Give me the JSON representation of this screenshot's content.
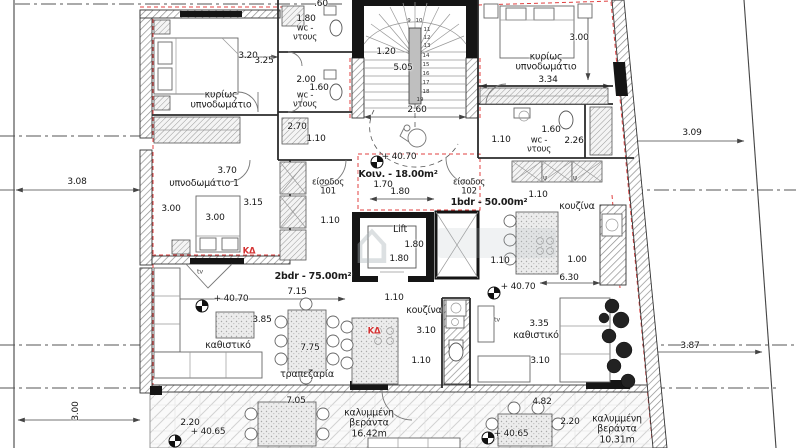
{
  "plan": {
    "drawing_type": "apartment floor plan",
    "apartments": [
      {
        "unit": "101",
        "label": "2bdr - 75.00m²"
      },
      {
        "unit": "102",
        "label": "1bdr - 50.00m²"
      },
      {
        "common": "Κοιν. - 18.00m²"
      }
    ],
    "colors": {
      "insulation_dashed": "#e04040",
      "kd_label": "#d43333",
      "wall_line": "#333333",
      "annotation_text": "#1b1b1b"
    },
    "room_labels": [
      {
        "t": "κυρίως\nυπνοδωμάτιο",
        "x": 221,
        "y": 101
      },
      {
        "t": "wc -\nντους",
        "x": 305,
        "y": 34,
        "cls": "s"
      },
      {
        "t": "wc -\nντους",
        "x": 305,
        "y": 101,
        "cls": "s"
      },
      {
        "t": "κυρίως\nυπνοδωμάτιο",
        "x": 546,
        "y": 63
      },
      {
        "t": "wc -\nντους",
        "x": 539,
        "y": 146,
        "cls": "s"
      },
      {
        "t": "υπνοδωμάτιο 1",
        "x": 204,
        "y": 184
      },
      {
        "t": "Κοιν. - 18.00m²",
        "x": 398,
        "y": 175,
        "cls": "b"
      },
      {
        "t": "είσοδος\n101",
        "x": 328,
        "y": 188,
        "cls": "s"
      },
      {
        "t": "είσοδος\n102",
        "x": 469,
        "y": 188,
        "cls": "s"
      },
      {
        "t": "1bdr - 50.00m²",
        "x": 489,
        "y": 203,
        "cls": "b"
      },
      {
        "t": "2bdr - 75.00m²",
        "x": 313,
        "y": 277,
        "cls": "b"
      },
      {
        "t": "κουζίνα",
        "x": 577,
        "y": 207
      },
      {
        "t": "κουζίνα",
        "x": 424,
        "y": 311
      },
      {
        "t": "καθιστικό",
        "x": 228,
        "y": 346
      },
      {
        "t": "καθιστικό",
        "x": 536,
        "y": 336
      },
      {
        "t": "τραπεζαρία",
        "x": 307,
        "y": 375
      },
      {
        "t": "καλυμμένη\nβεράντα\n16.42m",
        "x": 369,
        "y": 424
      },
      {
        "t": "καλυμμένη\nβεράντα\n10.31m",
        "x": 617,
        "y": 430
      },
      {
        "t": "Lift",
        "x": 400,
        "y": 230
      }
    ],
    "dimensions": [
      {
        "t": "3.20",
        "x": 248,
        "y": 57
      },
      {
        "t": "3.25",
        "x": 264,
        "y": 62
      },
      {
        "t": ".60",
        "x": 321,
        "y": 5
      },
      {
        "t": "1.80",
        "x": 306,
        "y": 20
      },
      {
        "t": "2.00",
        "x": 306,
        "y": 81
      },
      {
        "t": "1.60",
        "x": 319,
        "y": 89
      },
      {
        "t": "2.70",
        "x": 297,
        "y": 128
      },
      {
        "t": "1.10",
        "x": 316,
        "y": 140
      },
      {
        "t": "1.20",
        "x": 386,
        "y": 53
      },
      {
        "t": "5.05",
        "x": 403,
        "y": 69
      },
      {
        "t": "2.60",
        "x": 417,
        "y": 111
      },
      {
        "t": "3.00",
        "x": 579,
        "y": 39
      },
      {
        "t": "3.34",
        "x": 548,
        "y": 81
      },
      {
        "t": "1.10",
        "x": 501,
        "y": 141
      },
      {
        "t": "1.60",
        "x": 551,
        "y": 131
      },
      {
        "t": "2.26",
        "x": 574,
        "y": 142
      },
      {
        "t": "3.09",
        "x": 692,
        "y": 134
      },
      {
        "t": "3.08",
        "x": 77,
        "y": 183
      },
      {
        "t": "3.70",
        "x": 227,
        "y": 172
      },
      {
        "t": "3.00",
        "x": 171,
        "y": 210
      },
      {
        "t": "3.00",
        "x": 215,
        "y": 219
      },
      {
        "t": "3.15",
        "x": 253,
        "y": 204
      },
      {
        "t": "1.70",
        "x": 383,
        "y": 186
      },
      {
        "t": "1.80",
        "x": 400,
        "y": 193
      },
      {
        "t": "1.10",
        "x": 330,
        "y": 222
      },
      {
        "t": "1.80",
        "x": 414,
        "y": 246
      },
      {
        "t": "1.80",
        "x": 399,
        "y": 260
      },
      {
        "t": "1.10",
        "x": 500,
        "y": 262
      },
      {
        "t": "1.10",
        "x": 538,
        "y": 196
      },
      {
        "t": "1.00",
        "x": 577,
        "y": 261
      },
      {
        "t": "6.30",
        "x": 569,
        "y": 279
      },
      {
        "t": "7.15",
        "x": 297,
        "y": 293
      },
      {
        "t": "3.85",
        "x": 262,
        "y": 321
      },
      {
        "t": "7.75",
        "x": 310,
        "y": 349
      },
      {
        "t": "3.10",
        "x": 426,
        "y": 332
      },
      {
        "t": "1.10",
        "x": 421,
        "y": 362
      },
      {
        "t": "1.10",
        "x": 394,
        "y": 299
      },
      {
        "t": "3.35",
        "x": 539,
        "y": 325
      },
      {
        "t": "3.10",
        "x": 540,
        "y": 362
      },
      {
        "t": "3.87",
        "x": 690,
        "y": 347
      },
      {
        "t": "2.20",
        "x": 190,
        "y": 424
      },
      {
        "t": "7.05",
        "x": 296,
        "y": 402
      },
      {
        "t": "2.20",
        "x": 570,
        "y": 423
      },
      {
        "t": "4.82",
        "x": 542,
        "y": 403
      },
      {
        "t": "3.00",
        "x": 77,
        "y": 411,
        "rot": -90
      }
    ],
    "levels": [
      {
        "t": "+ 40.70",
        "x": 399,
        "y": 158,
        "bx": 377,
        "by": 162
      },
      {
        "t": "+ 40.70",
        "x": 231,
        "y": 300,
        "bx": 202,
        "by": 306
      },
      {
        "t": "+ 40.70",
        "x": 518,
        "y": 288,
        "bx": 494,
        "by": 293
      },
      {
        "t": "+ 40.65",
        "x": 208,
        "y": 433,
        "bx": 175,
        "by": 441
      },
      {
        "t": "+ 40.65",
        "x": 511,
        "y": 435,
        "bx": 488,
        "by": 438
      }
    ],
    "stair_numbers": [
      {
        "t": "9",
        "x": 409,
        "y": 21
      },
      {
        "t": "10",
        "x": 419,
        "y": 21
      },
      {
        "t": "11",
        "x": 427,
        "y": 30
      },
      {
        "t": "12",
        "x": 427,
        "y": 38
      },
      {
        "t": "13",
        "x": 427,
        "y": 46
      },
      {
        "t": "14",
        "x": 426,
        "y": 56
      },
      {
        "t": "15",
        "x": 426,
        "y": 65
      },
      {
        "t": "16",
        "x": 426,
        "y": 74
      },
      {
        "t": "17",
        "x": 426,
        "y": 83
      },
      {
        "t": "18",
        "x": 426,
        "y": 92
      },
      {
        "t": "19",
        "x": 420,
        "y": 100
      }
    ],
    "misc_labels": [
      {
        "t": "ΚΔ",
        "x": 249,
        "y": 252,
        "cls": "kd"
      },
      {
        "t": "ΚΔ",
        "x": 374,
        "y": 332,
        "cls": "kd"
      },
      {
        "t": "ψ",
        "x": 545,
        "y": 178
      },
      {
        "t": "ψ",
        "x": 575,
        "y": 178
      },
      {
        "t": "tv",
        "x": 200,
        "y": 272
      },
      {
        "t": "tv",
        "x": 497,
        "y": 320
      }
    ]
  }
}
